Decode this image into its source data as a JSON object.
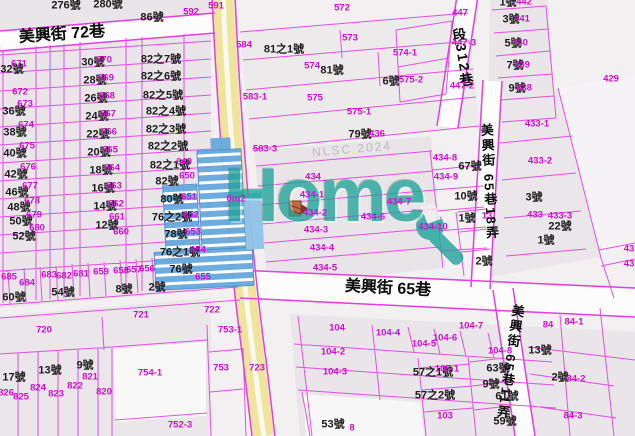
{
  "map": {
    "watermarks": {
      "logo": "Home",
      "agency": "NLSC 2024"
    },
    "colors": {
      "parcel_line": "#e23ee2",
      "parcel_number": "#cf10cf",
      "house_number": "#1d1d1d",
      "road_fill": "#f0e39b",
      "street_fill": "#fdfcfd",
      "block_fill": "#e9e5e8",
      "logo_teal": "#1ea49b",
      "building_blue": "#66a9de",
      "marker_orange": "#c06a43"
    },
    "label_layers": [
      {
        "name": "street-label",
        "cls": "street",
        "items": [
          {
            "text": "美興街 72巷",
            "x": 62,
            "y": 35,
            "rot": -4,
            "size": 16
          },
          {
            "text": "美興街 65巷",
            "x": 388,
            "y": 289,
            "rot": 3,
            "size": 16
          },
          {
            "text": "段312巷",
            "x": 463,
            "y": 58,
            "rot": -9,
            "size": 14,
            "vertical": true
          },
          {
            "text": "美興街 65巷18弄",
            "x": 489,
            "y": 182,
            "rot": -3,
            "size": 13,
            "vertical": true
          },
          {
            "text": "美興街 65巷11弄",
            "x": 510,
            "y": 362,
            "rot": 8,
            "size": 13,
            "vertical": true
          }
        ]
      },
      {
        "name": "house-number-label",
        "cls": "house",
        "items": [
          {
            "text": "276號",
            "x": 66,
            "y": 6
          },
          {
            "text": "280號",
            "x": 108,
            "y": 5
          },
          {
            "text": "86號",
            "x": 152,
            "y": 18
          },
          {
            "text": "32號",
            "x": 12,
            "y": 70
          },
          {
            "text": "36號",
            "x": 14,
            "y": 112
          },
          {
            "text": "38號",
            "x": 15,
            "y": 133
          },
          {
            "text": "40號",
            "x": 15,
            "y": 154
          },
          {
            "text": "42號",
            "x": 16,
            "y": 175
          },
          {
            "text": "46號",
            "x": 17,
            "y": 193
          },
          {
            "text": "48號",
            "x": 19,
            "y": 208
          },
          {
            "text": "50號",
            "x": 21,
            "y": 222
          },
          {
            "text": "52號",
            "x": 24,
            "y": 237
          },
          {
            "text": "60號",
            "x": 14,
            "y": 298
          },
          {
            "text": "54號",
            "x": 63,
            "y": 293
          },
          {
            "text": "8號",
            "x": 124,
            "y": 290
          },
          {
            "text": "2號",
            "x": 157,
            "y": 288
          },
          {
            "text": "17號",
            "x": 14,
            "y": 378
          },
          {
            "text": "13號",
            "x": 50,
            "y": 371
          },
          {
            "text": "9號",
            "x": 85,
            "y": 366
          },
          {
            "text": "30號",
            "x": 93,
            "y": 63
          },
          {
            "text": "28號",
            "x": 95,
            "y": 81
          },
          {
            "text": "26號",
            "x": 96,
            "y": 99
          },
          {
            "text": "24號",
            "x": 97,
            "y": 117
          },
          {
            "text": "22號",
            "x": 98,
            "y": 135
          },
          {
            "text": "20號",
            "x": 99,
            "y": 153
          },
          {
            "text": "18號",
            "x": 101,
            "y": 171
          },
          {
            "text": "16號",
            "x": 103,
            "y": 189
          },
          {
            "text": "14號",
            "x": 105,
            "y": 207
          },
          {
            "text": "12號",
            "x": 107,
            "y": 226
          },
          {
            "text": "82之7號",
            "x": 161,
            "y": 60
          },
          {
            "text": "82之6號",
            "x": 161,
            "y": 77
          },
          {
            "text": "82之5號",
            "x": 163,
            "y": 96
          },
          {
            "text": "82之4號",
            "x": 166,
            "y": 112
          },
          {
            "text": "82之3號",
            "x": 166,
            "y": 130
          },
          {
            "text": "82之2號",
            "x": 168,
            "y": 147
          },
          {
            "text": "82之1號",
            "x": 170,
            "y": 166
          },
          {
            "text": "82號",
            "x": 167,
            "y": 182
          },
          {
            "text": "80號",
            "x": 172,
            "y": 200
          },
          {
            "text": "76之2號",
            "x": 172,
            "y": 218
          },
          {
            "text": "78號",
            "x": 176,
            "y": 235
          },
          {
            "text": "76之1號",
            "x": 180,
            "y": 253
          },
          {
            "text": "76號",
            "x": 181,
            "y": 270
          },
          {
            "text": "81之1號",
            "x": 284,
            "y": 50
          },
          {
            "text": "81號",
            "x": 332,
            "y": 71
          },
          {
            "text": "6號",
            "x": 391,
            "y": 82
          },
          {
            "text": "79號",
            "x": 360,
            "y": 135
          },
          {
            "text": "1號",
            "x": 508,
            "y": 3
          },
          {
            "text": "3號",
            "x": 511,
            "y": 20
          },
          {
            "text": "5號",
            "x": 513,
            "y": 44
          },
          {
            "text": "7號",
            "x": 515,
            "y": 66
          },
          {
            "text": "9號",
            "x": 517,
            "y": 89
          },
          {
            "text": "67號",
            "x": 470,
            "y": 167
          },
          {
            "text": "10號",
            "x": 466,
            "y": 197
          },
          {
            "text": "3號",
            "x": 534,
            "y": 198
          },
          {
            "text": "22號",
            "x": 560,
            "y": 227
          },
          {
            "text": "1號",
            "x": 546,
            "y": 241
          },
          {
            "text": "1號",
            "x": 467,
            "y": 219
          },
          {
            "text": "2號",
            "x": 484,
            "y": 262
          },
          {
            "text": "63號",
            "x": 498,
            "y": 369
          },
          {
            "text": "61號",
            "x": 507,
            "y": 397
          },
          {
            "text": "59號",
            "x": 505,
            "y": 422
          },
          {
            "text": "9號",
            "x": 491,
            "y": 385
          },
          {
            "text": "53號",
            "x": 333,
            "y": 425
          },
          {
            "text": "57之1號",
            "x": 433,
            "y": 373
          },
          {
            "text": "57之2號",
            "x": 435,
            "y": 396
          },
          {
            "text": "13號",
            "x": 540,
            "y": 351
          },
          {
            "text": "2號",
            "x": 560,
            "y": 378
          }
        ]
      },
      {
        "name": "parcel-number-label",
        "cls": "parcel",
        "items": [
          {
            "text": "592",
            "x": 191,
            "y": 12
          },
          {
            "text": "591",
            "x": 216,
            "y": 6
          },
          {
            "text": "572",
            "x": 342,
            "y": 8
          },
          {
            "text": "573",
            "x": 350,
            "y": 38
          },
          {
            "text": "574",
            "x": 312,
            "y": 66
          },
          {
            "text": "574-1",
            "x": 405,
            "y": 53
          },
          {
            "text": "575",
            "x": 315,
            "y": 98
          },
          {
            "text": "575-1",
            "x": 359,
            "y": 112
          },
          {
            "text": "575-2",
            "x": 411,
            "y": 80
          },
          {
            "text": "583-1",
            "x": 255,
            "y": 97
          },
          {
            "text": "583-3",
            "x": 265,
            "y": 149
          },
          {
            "text": "584",
            "x": 244,
            "y": 45
          },
          {
            "text": "436",
            "x": 377,
            "y": 134
          },
          {
            "text": "434",
            "x": 313,
            "y": 177
          },
          {
            "text": "434-1",
            "x": 312,
            "y": 195
          },
          {
            "text": "434-2",
            "x": 315,
            "y": 213
          },
          {
            "text": "434-3",
            "x": 316,
            "y": 230
          },
          {
            "text": "434-4",
            "x": 322,
            "y": 248
          },
          {
            "text": "434-5",
            "x": 325,
            "y": 268
          },
          {
            "text": "434-6",
            "x": 373,
            "y": 217
          },
          {
            "text": "434-7",
            "x": 399,
            "y": 202
          },
          {
            "text": "434-8",
            "x": 445,
            "y": 158
          },
          {
            "text": "434-9",
            "x": 446,
            "y": 177
          },
          {
            "text": "434-10",
            "x": 433,
            "y": 227
          },
          {
            "text": "13",
            "x": 487,
            "y": 216
          },
          {
            "text": "433-1",
            "x": 537,
            "y": 124
          },
          {
            "text": "433-2",
            "x": 540,
            "y": 161
          },
          {
            "text": "433",
            "x": 535,
            "y": 215
          },
          {
            "text": "433-3",
            "x": 560,
            "y": 216
          },
          {
            "text": "447",
            "x": 460,
            "y": 13
          },
          {
            "text": "447-3",
            "x": 464,
            "y": 43
          },
          {
            "text": "447-2",
            "x": 462,
            "y": 86
          },
          {
            "text": "429",
            "x": 611,
            "y": 79
          },
          {
            "text": "442",
            "x": 524,
            "y": 2
          },
          {
            "text": "441",
            "x": 522,
            "y": 19
          },
          {
            "text": "440",
            "x": 520,
            "y": 43
          },
          {
            "text": "439",
            "x": 522,
            "y": 65
          },
          {
            "text": "438",
            "x": 524,
            "y": 88
          },
          {
            "text": "43",
            "x": 629,
            "y": 249
          },
          {
            "text": "43",
            "x": 629,
            "y": 264
          },
          {
            "text": "671",
            "x": 19,
            "y": 64
          },
          {
            "text": "672",
            "x": 20,
            "y": 92
          },
          {
            "text": "673",
            "x": 25,
            "y": 104
          },
          {
            "text": "674",
            "x": 26,
            "y": 125
          },
          {
            "text": "675",
            "x": 27,
            "y": 146
          },
          {
            "text": "676",
            "x": 28,
            "y": 167
          },
          {
            "text": "677",
            "x": 30,
            "y": 186
          },
          {
            "text": "678",
            "x": 32,
            "y": 201
          },
          {
            "text": "679",
            "x": 34,
            "y": 215
          },
          {
            "text": "680",
            "x": 37,
            "y": 228
          },
          {
            "text": "670",
            "x": 104,
            "y": 60
          },
          {
            "text": "669",
            "x": 106,
            "y": 78
          },
          {
            "text": "668",
            "x": 107,
            "y": 96
          },
          {
            "text": "667",
            "x": 108,
            "y": 114
          },
          {
            "text": "666",
            "x": 109,
            "y": 132
          },
          {
            "text": "665",
            "x": 110,
            "y": 150
          },
          {
            "text": "664",
            "x": 112,
            "y": 168
          },
          {
            "text": "663",
            "x": 114,
            "y": 186
          },
          {
            "text": "662",
            "x": 116,
            "y": 204
          },
          {
            "text": "661",
            "x": 117,
            "y": 217
          },
          {
            "text": "660",
            "x": 121,
            "y": 232
          },
          {
            "text": "649",
            "x": 184,
            "y": 162
          },
          {
            "text": "650",
            "x": 187,
            "y": 176
          },
          {
            "text": "651",
            "x": 189,
            "y": 197
          },
          {
            "text": "652",
            "x": 191,
            "y": 215
          },
          {
            "text": "653",
            "x": 193,
            "y": 232
          },
          {
            "text": "654",
            "x": 198,
            "y": 250
          },
          {
            "text": "655",
            "x": 203,
            "y": 277
          },
          {
            "text": "685",
            "x": 9,
            "y": 277
          },
          {
            "text": "684",
            "x": 27,
            "y": 283
          },
          {
            "text": "683",
            "x": 49,
            "y": 275
          },
          {
            "text": "682",
            "x": 64,
            "y": 276
          },
          {
            "text": "681",
            "x": 81,
            "y": 274
          },
          {
            "text": "659",
            "x": 101,
            "y": 272
          },
          {
            "text": "658",
            "x": 121,
            "y": 271
          },
          {
            "text": "657",
            "x": 134,
            "y": 270
          },
          {
            "text": "656",
            "x": 147,
            "y": 269
          },
          {
            "text": "720",
            "x": 44,
            "y": 330
          },
          {
            "text": "721",
            "x": 141,
            "y": 315
          },
          {
            "text": "722",
            "x": 212,
            "y": 310
          },
          {
            "text": "753-1",
            "x": 230,
            "y": 330
          },
          {
            "text": "753",
            "x": 221,
            "y": 368
          },
          {
            "text": "723",
            "x": 257,
            "y": 368
          },
          {
            "text": "754-1",
            "x": 150,
            "y": 373
          },
          {
            "text": "752-3",
            "x": 180,
            "y": 425
          },
          {
            "text": "826",
            "x": 6,
            "y": 393
          },
          {
            "text": "825",
            "x": 21,
            "y": 397
          },
          {
            "text": "824",
            "x": 38,
            "y": 388
          },
          {
            "text": "823",
            "x": 56,
            "y": 394
          },
          {
            "text": "822",
            "x": 75,
            "y": 386
          },
          {
            "text": "821",
            "x": 90,
            "y": 377
          },
          {
            "text": "820",
            "x": 104,
            "y": 392
          },
          {
            "text": "104",
            "x": 337,
            "y": 328
          },
          {
            "text": "104-2",
            "x": 333,
            "y": 352
          },
          {
            "text": "104-3",
            "x": 335,
            "y": 372
          },
          {
            "text": "104-4",
            "x": 388,
            "y": 333
          },
          {
            "text": "104-5",
            "x": 424,
            "y": 344
          },
          {
            "text": "104-6",
            "x": 445,
            "y": 338
          },
          {
            "text": "104-7",
            "x": 471,
            "y": 326
          },
          {
            "text": "104-8",
            "x": 500,
            "y": 351
          },
          {
            "text": "103",
            "x": 445,
            "y": 416
          },
          {
            "text": "105-1",
            "x": 447,
            "y": 369
          },
          {
            "text": "8",
            "x": 352,
            "y": 428
          },
          {
            "text": "84",
            "x": 548,
            "y": 325
          },
          {
            "text": "84-1",
            "x": 574,
            "y": 322
          },
          {
            "text": "84-2",
            "x": 576,
            "y": 379
          },
          {
            "text": "84-3",
            "x": 573,
            "y": 416
          },
          {
            "text": "0m2",
            "x": 236,
            "y": 199
          }
        ]
      }
    ]
  }
}
